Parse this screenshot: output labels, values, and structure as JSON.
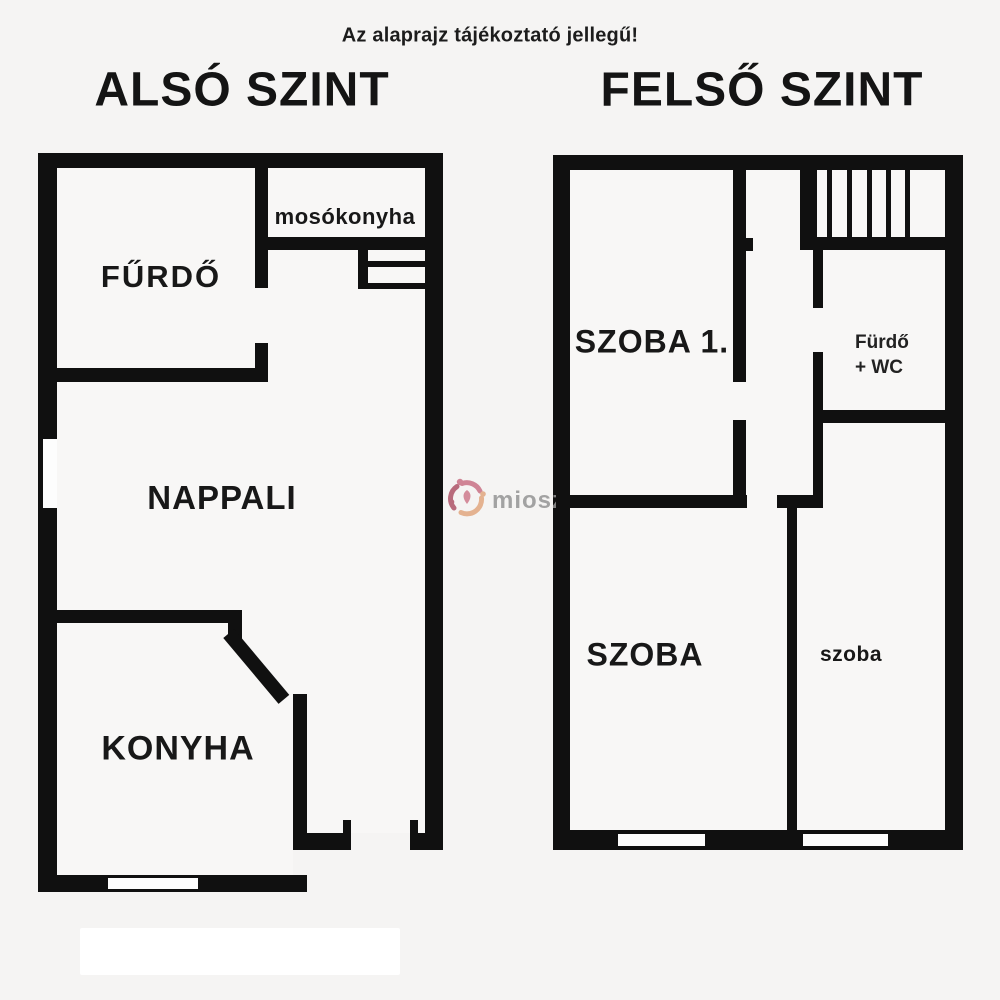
{
  "disclaimer": "Az alaprajz tájékoztató jellegű!",
  "floors": {
    "lower": {
      "title": "ALSÓ SZINT",
      "rooms": {
        "furdo": "FŰRDŐ",
        "mosokonyha": "mosókonyha",
        "nappali": "NAPPALI",
        "konyha": "KONYHA"
      }
    },
    "upper": {
      "title": "FELSŐ SZINT",
      "rooms": {
        "szoba1": "SZOBA 1.",
        "furdo_wc_line1": "Fürdő",
        "furdo_wc_line2": "+ WC",
        "szoba": "SZOBA",
        "szoba_small": "szoba"
      }
    }
  },
  "watermark": {
    "brand": "miosz"
  },
  "colors": {
    "wall": "#101010",
    "background": "#f5f4f3",
    "text": "#181818",
    "watermark_text": "#949494",
    "logo_rose": "#c97185",
    "logo_dark_rose": "#ae5468",
    "logo_salmon": "#e2a77f"
  }
}
